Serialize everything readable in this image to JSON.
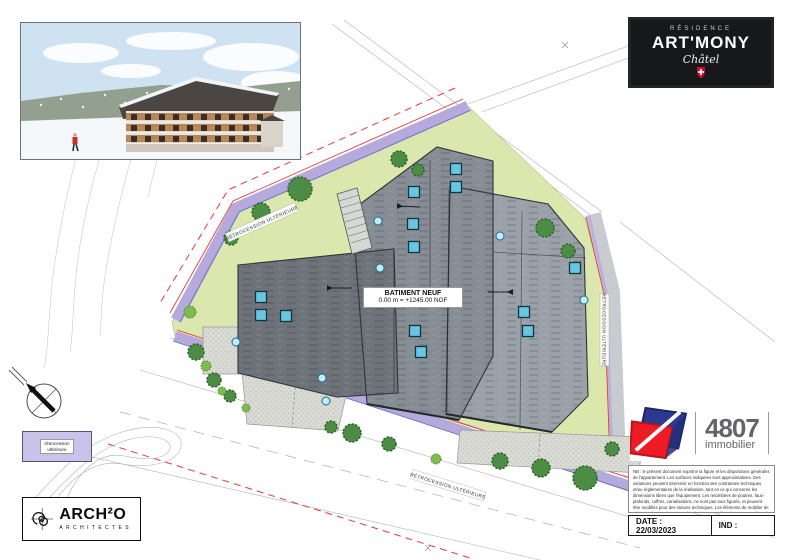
{
  "badge": {
    "residence": "RÉSIDENCE",
    "name": "ART'MONY",
    "place": "Châtel"
  },
  "plan": {
    "building_label": {
      "line1": "BATIMENT NEUF",
      "line2": "0.00 m = +1245.00 NGF"
    },
    "band_label_top": "RÉTROCESSION ULTÉRIEURE",
    "band_label_bottom": "RÉTROCESSION ULTÉRIEURE",
    "band_label_right": "RÉTROCESSION ULTÉRIEURE",
    "legend": {
      "line1": "rétrocession",
      "line2": "ultérieure"
    }
  },
  "architect": {
    "name": "ARCH²O",
    "subtitle": "ARCHITECTES"
  },
  "agency": {
    "number": "4807",
    "label": "immobilier"
  },
  "notice": {
    "text": "NB : le présent document exprime la figure et les dispositions générales de l'appartement. Les surfaces indiquées sont approximatives. Des variations peuvent intervenir en fonction des contraintes techniques et/ou réglementaires de la réalisation, tant en ce qui concerne les dimensions libres que l'équipement. Les retombées de poutres, faux-plafonds, coffres, canalisations, ne sont pas tous figurés, et peuvent être modifiés pour des raisons techniques. Les éléments de mobilier de cuisine et les implantations des équipements électriques sont présentés à titre indicatif et ne sont pas contractuels. Les éventuelles plantations dans les jardins privatifs ou espaces communs ne sont pas contractuelles."
  },
  "titleblock": {
    "date": "DATE : 22/03/2023",
    "ind": "IND :"
  },
  "colors": {
    "parcel_green": "#dbe7ad",
    "band_purple": "#b5aadb",
    "roof_dark": "#6d7379",
    "roof_mid": "#878d95",
    "roof_light": "#9aa1a9",
    "skylight_blue": "#69c6e0",
    "red_line": "#e03c3c",
    "badge_black": "#17181a",
    "logo_blue": "#2b3990",
    "logo_red": "#ed1c24"
  }
}
